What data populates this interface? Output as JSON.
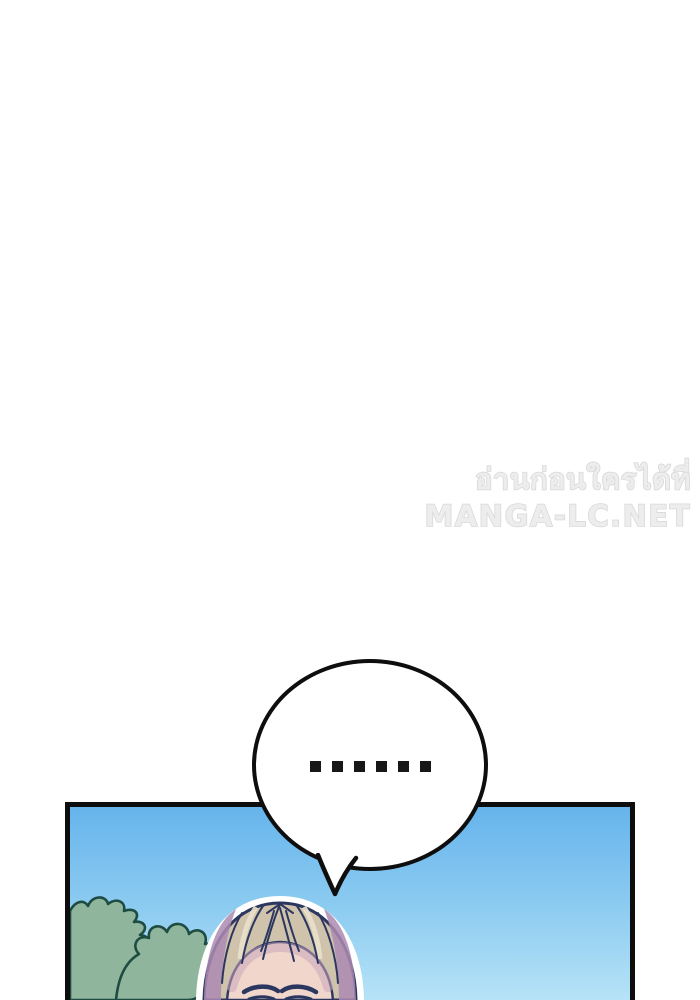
{
  "watermark": {
    "line1": "อ่านก่อนใครได้ที่",
    "line2": "MANGA-LC.NET"
  },
  "speech_bubble": {
    "dots_text": "......",
    "dot_count": 6
  },
  "panel": {
    "scene": "sky with bushes and blond character head",
    "elements": [
      "sky",
      "bush-left",
      "bush-right",
      "character-head"
    ]
  },
  "colors": {
    "page_background": "#ffffff",
    "watermark_text": "#ededed",
    "watermark_stroke": "#d8d8d8",
    "bubble_fill": "#ffffff",
    "bubble_border": "#0e0e0e",
    "dot_color": "#171717",
    "panel_border": "#0d0d0d",
    "sky_top": "#66b4ec",
    "sky_bottom": "#b6e3f7",
    "bush_fill": "#8fb59d",
    "bush_outline": "#1e4b42",
    "hair_base": "#cfc3ab",
    "hair_highlight": "#e9e0cb",
    "hair_shadow_mauve": "#ab89b2",
    "line_art_navy": "#2c3760",
    "skin": "#f1d7cb",
    "skin_shadow": "#c9a6be",
    "head_outline": "#ffffff"
  }
}
